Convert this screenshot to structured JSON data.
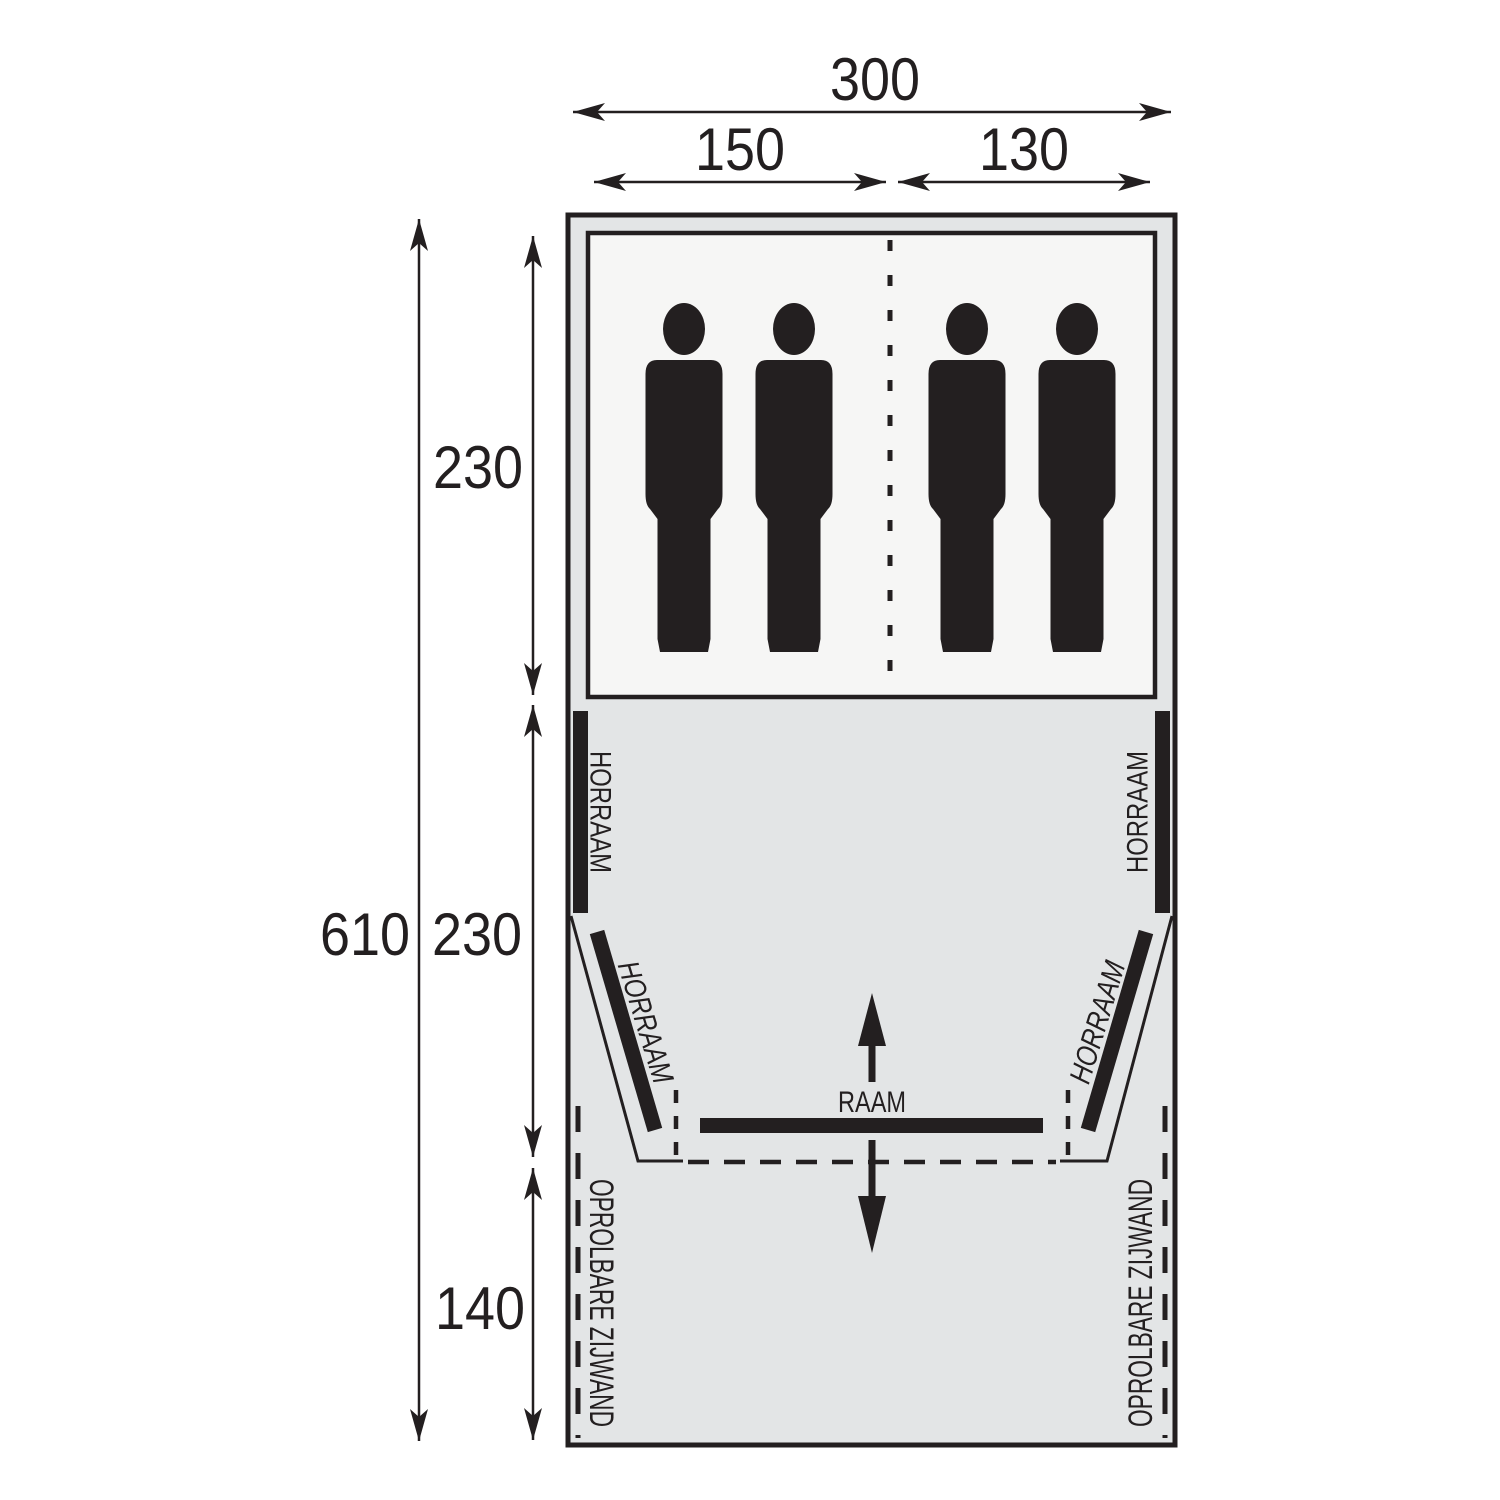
{
  "diagram": {
    "type": "tent-floorplan",
    "dimensions": {
      "total_width": "300",
      "left_berth_width": "150",
      "right_berth_width": "130",
      "total_length": "610",
      "sleeping_length": "230",
      "living_length": "230",
      "canopy_length": "140"
    },
    "labels": {
      "screen_window": "HORRAAM",
      "window": "RAAM",
      "rollup_sidewall": "OPROLBARE ZIJWAND"
    },
    "colors": {
      "background": "#ffffff",
      "tent_fill": "#e3e5e6",
      "sleeping_fill": "#f6f6f5",
      "line": "#231f20"
    },
    "people_count": 4
  }
}
